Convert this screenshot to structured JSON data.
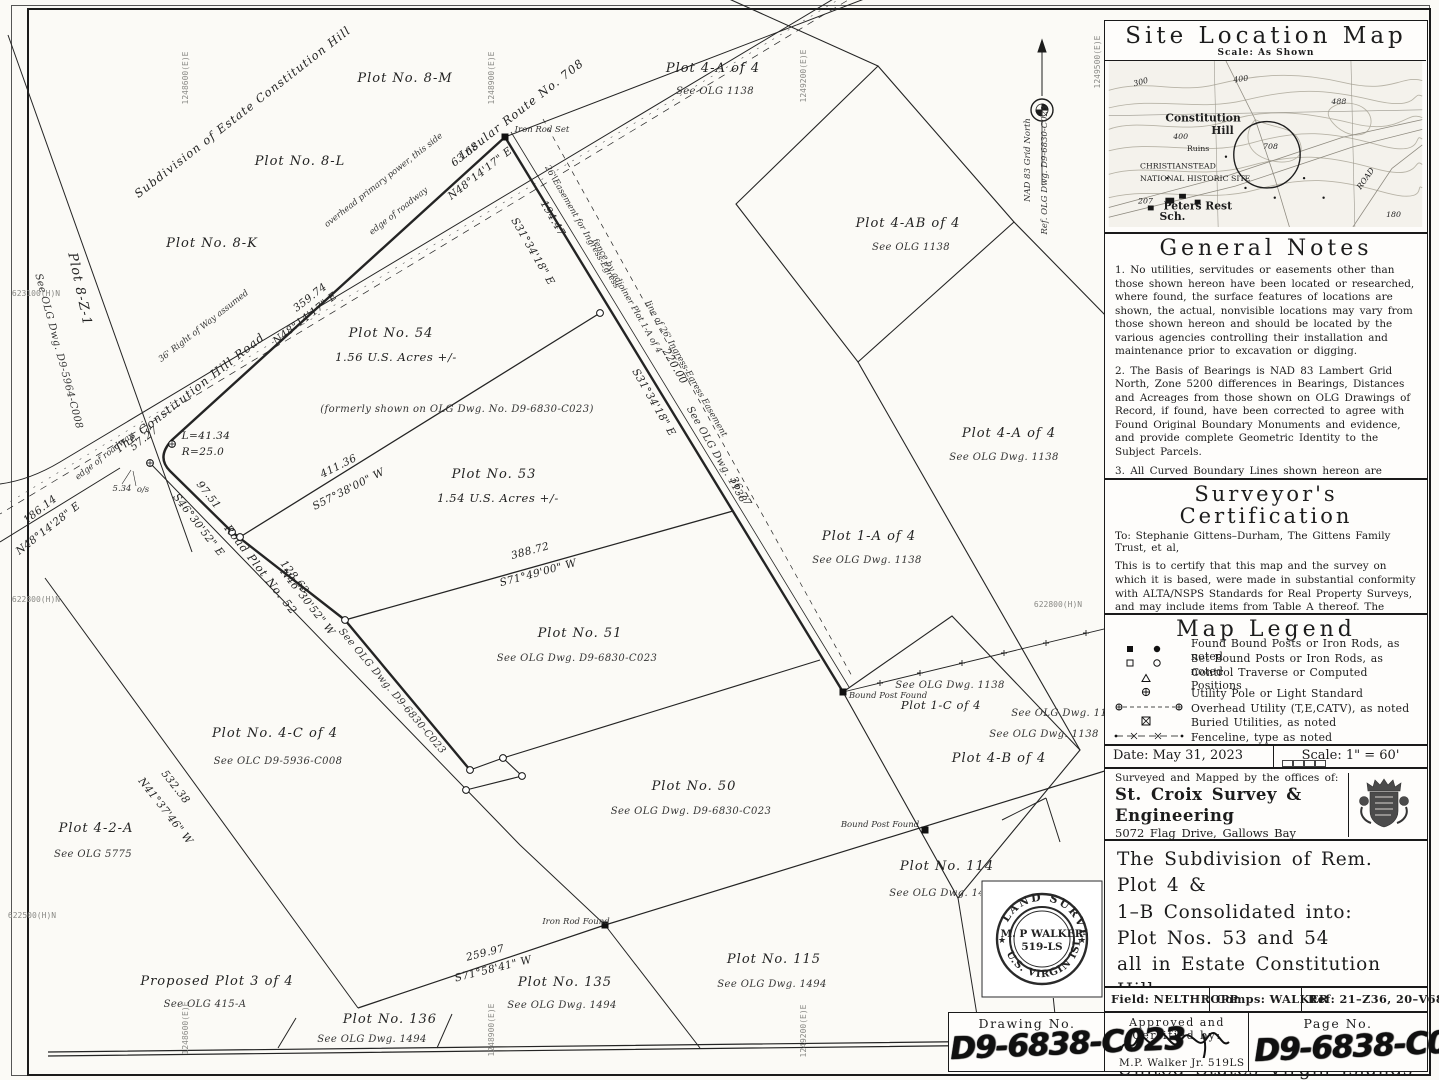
{
  "site_map": {
    "title": "Site Location Map",
    "scale_note": "Scale: As Shown",
    "topo_labels": [
      {
        "t": "300",
        "x": 26,
        "y": 26,
        "r": -15,
        "c": "sm"
      },
      {
        "t": "400",
        "x": 128,
        "y": 22,
        "r": -8,
        "c": "sm"
      },
      {
        "t": "488",
        "x": 228,
        "y": 44,
        "r": 0,
        "c": "sm"
      },
      {
        "t": "Constitution",
        "x": 58,
        "y": 62,
        "r": 0,
        "c": "big"
      },
      {
        "t": "Hill",
        "x": 105,
        "y": 75,
        "r": 0,
        "c": "big"
      },
      {
        "t": "400",
        "x": 66,
        "y": 80,
        "r": 0,
        "c": "sm"
      },
      {
        "t": "Ruins",
        "x": 80,
        "y": 92,
        "r": 0,
        "c": "med"
      },
      {
        "t": "708",
        "x": 158,
        "y": 90,
        "r": 0,
        "c": "sm"
      },
      {
        "t": "CHRISTIANSTEAD",
        "x": 32,
        "y": 110,
        "r": 0,
        "c": "med"
      },
      {
        "t": "NATIONAL HISTORIC SITE",
        "x": 32,
        "y": 123,
        "r": 0,
        "c": "med"
      },
      {
        "t": "207",
        "x": 30,
        "y": 146,
        "r": 0,
        "c": "sm"
      },
      {
        "t": "Peters Rest",
        "x": 56,
        "y": 152,
        "r": 0,
        "c": "big"
      },
      {
        "t": "Sch.",
        "x": 52,
        "y": 163,
        "r": 0,
        "c": "big"
      },
      {
        "t": "ROAD",
        "x": 258,
        "y": 132,
        "r": -55,
        "c": "sm"
      },
      {
        "t": "180",
        "x": 284,
        "y": 160,
        "r": 0,
        "c": "sm"
      }
    ]
  },
  "general_notes": {
    "title": "General Notes",
    "notes": [
      "1. No utilities, servitudes or easements other than those shown hereon have been located or researched, where found, the surface features of locations are shown, the actual, nonvisible locations may vary from those shown hereon and should be located by the various agencies controlling their installation and maintenance prior to excavation or digging.",
      "2. The Basis of Bearings is NAD 83 Lambert Grid North, Zone 5200 differences in Bearings, Distances and Acreages from those shown on OLG Drawings of Record, if found, have been corrected to agree with Found Original Boundary Monuments and evidence, and provide complete Geometric Identity to the Subject Parcels.",
      "3. All Curved Boundary Lines shown hereon are tangential to their connecting lines unless specifically shown otherwise.",
      "4. Pt. \"A\" shown hereon was held good for initial Record Position Line \"A\"–\"B\" was held good for Record Direction and all Found Monuments and Improvements were rotated and translated thereto.",
      "5. Subject Parcels appear to be in F.E.M.A. Flood Zone X.",
      "6. Subject Parcels appear to be in Planning Board Zone R–1.",
      "7. Reference OLG Dwg. (D9–6830–C023), and others, as noted."
    ]
  },
  "certification": {
    "title": "Surveyor's Certification",
    "to": "To: Stephanie Gittens–Durham, The Gittens Family Trust, et al,",
    "body": "This is to certify that this map and the survey on which it is based, were made in substantial conformity with ALTA/NSPS Standards for Real Property Surveys, and may include items from Table A thereof. The measurement of lines, angles and distances shown hereon, and the coordinates calculated from same, if shown, are in substantial conformity with positional tolerances established and accepted as best practices in the United States Virgin Islands, as of this date.",
    "date": "Date: May 31, 2023",
    "signed": "Signed: M.P. Walker Jr. PLS 519 LS"
  },
  "map_legend": {
    "title": "Map Legend",
    "rows": [
      {
        "sym": "found",
        "label": "Found Bound Posts or Iron Rods, as noted"
      },
      {
        "sym": "set",
        "label": "Set Bound Posts or Iron Rods, as noted"
      },
      {
        "sym": "traverse",
        "label": "Control Traverse or Computed Positions"
      },
      {
        "sym": "pole",
        "label": "Utility Pole or Light Standard"
      },
      {
        "sym": "overhead",
        "label": "Overhead Utility (T,E,CATV), as noted"
      },
      {
        "sym": "buried",
        "label": "Buried Utilities, as noted"
      },
      {
        "sym": "fence",
        "label": "Fenceline, type as noted"
      },
      {
        "sym": "boundary",
        "label": "Subject Plot Boundary Line"
      }
    ]
  },
  "daterow": {
    "date": "Date: May 31, 2023",
    "scale": "Scale: 1\" = 60'"
  },
  "firm": {
    "intro": "Surveyed and Mapped by the offices of:",
    "name": "St. Croix Survey & Engineering",
    "addr1": "5072 Flag Drive, Gallows Bay",
    "addr2": "Christiansted, V.I. 00820",
    "tel": "Tlf.:340.773.5577",
    "web": "www.stxsurvey.com"
  },
  "title_block": {
    "lines": [
      "The Subdivision of Rem. Plot 4 &",
      "1–B Consolidated into:",
      "Plot Nos. 53 and 54",
      "all in Estate Constitution Hill",
      "in the Company Quarter",
      "Island of St. Croix",
      "United States Virgin Islands"
    ]
  },
  "refs": {
    "field": "Field: NELTHROPP",
    "comps": "Comps: WALKER",
    "ref": "Ref: 21–Z36, 20–V68"
  },
  "bottom": {
    "drawing_label": "Drawing No.",
    "drawing_no": "D9-6838-C023",
    "approved_label": "Approved and Certified by:",
    "approver": "M.P. Walker Jr. 519LS",
    "page_label": "Page No.",
    "page_no": "D9-6838-C023"
  },
  "seal": {
    "top": "LAND SURVEYOR",
    "name": "M. P WALKER",
    "number": "519-LS",
    "bottom": "U.S. VIRGIN ISLANDS"
  },
  "map": {
    "labels": [
      {
        "t": "Subdivision of Estate Constitution Hill",
        "x": 245,
        "y": 115,
        "r": -38,
        "c": "road"
      },
      {
        "t": "Plot No. 8-M",
        "x": 405,
        "y": 82,
        "r": 0,
        "c": "plot"
      },
      {
        "t": "Plot No. 8-L",
        "x": 300,
        "y": 165,
        "r": 0,
        "c": "plot"
      },
      {
        "t": "Plot No. 8-K",
        "x": 212,
        "y": 247,
        "r": 0,
        "c": "plot"
      },
      {
        "t": "Plot 8-Z-1",
        "x": 76,
        "y": 290,
        "r": 78,
        "c": "plot"
      },
      {
        "t": "See OLG Dwg. D9-5964-C008",
        "x": 56,
        "y": 352,
        "r": 75,
        "c": "ref"
      },
      {
        "t": "Insular Route No. 708",
        "x": 524,
        "y": 112,
        "r": -38,
        "c": "road"
      },
      {
        "t": "Iron Rod Set",
        "x": 542,
        "y": 132,
        "r": 0,
        "c": "tiny"
      },
      {
        "t": "63.68",
        "x": 467,
        "y": 157,
        "r": -38,
        "c": "dim"
      },
      {
        "t": "N48°14'17\" E",
        "x": 482,
        "y": 176,
        "r": -38,
        "c": "dim"
      },
      {
        "t": "overhead primary power, this side",
        "x": 385,
        "y": 182,
        "r": -38,
        "c": "tiny"
      },
      {
        "t": "edge of roadway",
        "x": 400,
        "y": 213,
        "r": -38,
        "c": "tiny"
      },
      {
        "t": "36' Right of Way assumed",
        "x": 205,
        "y": 328,
        "r": -38,
        "c": "tiny"
      },
      {
        "t": "edge of roadway",
        "x": 106,
        "y": 458,
        "r": -38,
        "c": "tiny"
      },
      {
        "t": "The Constitution Hill Road",
        "x": 192,
        "y": 396,
        "r": -38,
        "c": "road"
      },
      {
        "t": "359.74",
        "x": 312,
        "y": 300,
        "r": -38,
        "c": "dim"
      },
      {
        "t": "N48°14'17\" E",
        "x": 307,
        "y": 321,
        "r": -38,
        "c": "dim"
      },
      {
        "t": "194.47",
        "x": 550,
        "y": 220,
        "r": 60,
        "c": "dim"
      },
      {
        "t": "S31°34'18\" E",
        "x": 530,
        "y": 253,
        "r": 60,
        "c": "dim"
      },
      {
        "t": "26' Easement for Ingress-Egress",
        "x": 580,
        "y": 228,
        "r": 60,
        "c": "tiny"
      },
      {
        "t": "fence by adjoiner Plot 1-A of 4",
        "x": 625,
        "y": 297,
        "r": 60,
        "c": "tiny"
      },
      {
        "t": "line of 26' Ingress-Egress Easement",
        "x": 684,
        "y": 370,
        "r": 60,
        "c": "tiny"
      },
      {
        "t": "220.00",
        "x": 672,
        "y": 368,
        "r": 60,
        "c": "dim"
      },
      {
        "t": "S31°34'18\" E",
        "x": 651,
        "y": 404,
        "r": 60,
        "c": "dim"
      },
      {
        "t": "See OLG Dwg. 1138",
        "x": 714,
        "y": 456,
        "r": 60,
        "c": "ref"
      },
      {
        "t": "36.77",
        "x": 738,
        "y": 493,
        "r": 60,
        "c": "dim"
      },
      {
        "t": "Plot No. 54",
        "x": 391,
        "y": 337,
        "r": 0,
        "c": "plot"
      },
      {
        "t": "1.56 U.S. Acres +/-",
        "x": 396,
        "y": 361,
        "r": 0,
        "c": "plot2"
      },
      {
        "t": "(formerly shown on OLG Dwg. No. D9-6830-C023)",
        "x": 457,
        "y": 412,
        "r": 0,
        "c": "ref"
      },
      {
        "t": "L=41.34",
        "x": 206,
        "y": 439,
        "r": 0,
        "c": "dim"
      },
      {
        "t": "R=25.0",
        "x": 203,
        "y": 455,
        "r": 0,
        "c": "dim"
      },
      {
        "t": "57.27",
        "x": 146,
        "y": 441,
        "r": -38,
        "c": "dim"
      },
      {
        "t": "5.34",
        "x": 122,
        "y": 491,
        "r": 0,
        "c": "tiny"
      },
      {
        "t": "o/s",
        "x": 143,
        "y": 492,
        "r": 0,
        "c": "tiny"
      },
      {
        "t": "186.14",
        "x": 42,
        "y": 512,
        "r": -38,
        "c": "dim"
      },
      {
        "t": "N48°14'28\" E",
        "x": 50,
        "y": 531,
        "r": -38,
        "c": "dim"
      },
      {
        "t": "411.36",
        "x": 340,
        "y": 469,
        "r": -27,
        "c": "dim"
      },
      {
        "t": "S57°38'00\" W",
        "x": 350,
        "y": 492,
        "r": -27,
        "c": "dim"
      },
      {
        "t": "Plot No. 53",
        "x": 494,
        "y": 478,
        "r": 0,
        "c": "plot"
      },
      {
        "t": "1.54 U.S. Acres +/-",
        "x": 498,
        "y": 502,
        "r": 0,
        "c": "plot2"
      },
      {
        "t": "97.51",
        "x": 206,
        "y": 497,
        "r": 52,
        "c": "dim"
      },
      {
        "t": "S46°30'52\" E",
        "x": 196,
        "y": 527,
        "r": 52,
        "c": "dim"
      },
      {
        "t": "Road Plot No. 52",
        "x": 258,
        "y": 572,
        "r": 52,
        "c": "road2"
      },
      {
        "t": "128.63",
        "x": 292,
        "y": 579,
        "r": 52,
        "c": "dim"
      },
      {
        "t": "N46°30'52\" W",
        "x": 305,
        "y": 604,
        "r": 52,
        "c": "dim"
      },
      {
        "t": "388.72",
        "x": 531,
        "y": 554,
        "r": -15,
        "c": "dim"
      },
      {
        "t": "S71°49'00\" W",
        "x": 539,
        "y": 576,
        "r": -15,
        "c": "dim"
      },
      {
        "t": "Plot No. 51",
        "x": 580,
        "y": 637,
        "r": 0,
        "c": "plot"
      },
      {
        "t": "See OLG Dwg. D9-6830-C023",
        "x": 577,
        "y": 661,
        "r": 0,
        "c": "ref"
      },
      {
        "t": "See OLG Dwg. D9-6830-C023",
        "x": 390,
        "y": 693,
        "r": 50,
        "c": "ref"
      },
      {
        "t": "Plot No. 4-C of 4",
        "x": 275,
        "y": 737,
        "r": 0,
        "c": "plot"
      },
      {
        "t": "See OLC D9-5936-C008",
        "x": 278,
        "y": 764,
        "r": 0,
        "c": "ref"
      },
      {
        "t": "532.38",
        "x": 173,
        "y": 789,
        "r": 52,
        "c": "dim"
      },
      {
        "t": "N41°37'46\" W",
        "x": 163,
        "y": 813,
        "r": 52,
        "c": "dim"
      },
      {
        "t": "Plot 4-2-A",
        "x": 96,
        "y": 832,
        "r": 0,
        "c": "plot"
      },
      {
        "t": "See OLG 5775",
        "x": 93,
        "y": 857,
        "r": 0,
        "c": "ref"
      },
      {
        "t": "Plot No. 50",
        "x": 694,
        "y": 790,
        "r": 0,
        "c": "plot"
      },
      {
        "t": "See OLG Dwg. D9-6830-C023",
        "x": 691,
        "y": 814,
        "r": 0,
        "c": "ref"
      },
      {
        "t": "Plot 1-A of 4",
        "x": 869,
        "y": 540,
        "r": 0,
        "c": "plot"
      },
      {
        "t": "See OLG Dwg. 1138",
        "x": 867,
        "y": 563,
        "r": 0,
        "c": "ref"
      },
      {
        "t": "Plot 4-A of 4",
        "x": 1009,
        "y": 437,
        "r": 0,
        "c": "plot"
      },
      {
        "t": "See OLG Dwg. 1138",
        "x": 1004,
        "y": 460,
        "r": 0,
        "c": "ref"
      },
      {
        "t": "Plot 4-A of 4",
        "x": 713,
        "y": 72,
        "r": 0,
        "c": "plot"
      },
      {
        "t": "See OLG 1138",
        "x": 715,
        "y": 94,
        "r": 0,
        "c": "ref"
      },
      {
        "t": "Plot 4-AB of 4",
        "x": 908,
        "y": 227,
        "r": 0,
        "c": "plot"
      },
      {
        "t": "See OLG 1138",
        "x": 911,
        "y": 250,
        "r": 0,
        "c": "ref"
      },
      {
        "t": "Bound Post Found",
        "x": 888,
        "y": 698,
        "r": 0,
        "c": "tiny"
      },
      {
        "t": "See OLG Dwg. 1138",
        "x": 950,
        "y": 688,
        "r": 0,
        "c": "ref"
      },
      {
        "t": "Plot 1-C of 4",
        "x": 941,
        "y": 709,
        "r": 0,
        "c": "plot2"
      },
      {
        "t": "See OLG Dwg. 1138",
        "x": 1066,
        "y": 716,
        "r": 0,
        "c": "ref"
      },
      {
        "t": "See OLG Dwg. 1138",
        "x": 1044,
        "y": 737,
        "r": 0,
        "c": "ref"
      },
      {
        "t": "Plot 4-B of 4",
        "x": 999,
        "y": 762,
        "r": 0,
        "c": "plot"
      },
      {
        "t": "Plot No. 114",
        "x": 947,
        "y": 870,
        "r": 0,
        "c": "plot"
      },
      {
        "t": "See OLG Dwg. 1494",
        "x": 944,
        "y": 896,
        "r": 0,
        "c": "ref"
      },
      {
        "t": "Bound Post Found",
        "x": 880,
        "y": 827,
        "r": 0,
        "c": "tiny"
      },
      {
        "t": "Iron Rod Found",
        "x": 576,
        "y": 924,
        "r": 0,
        "c": "tiny"
      },
      {
        "t": "259.97",
        "x": 486,
        "y": 956,
        "r": -14,
        "c": "dim"
      },
      {
        "t": "S71°58'41\" W",
        "x": 494,
        "y": 972,
        "r": -14,
        "c": "dim"
      },
      {
        "t": "Plot No. 135",
        "x": 565,
        "y": 986,
        "r": 0,
        "c": "plot"
      },
      {
        "t": "See OLG Dwg. 1494",
        "x": 562,
        "y": 1008,
        "r": 0,
        "c": "ref"
      },
      {
        "t": "Plot No. 115",
        "x": 774,
        "y": 963,
        "r": 0,
        "c": "plot"
      },
      {
        "t": "See OLG Dwg. 1494",
        "x": 772,
        "y": 987,
        "r": 0,
        "c": "ref"
      },
      {
        "t": "Plot No. 136",
        "x": 390,
        "y": 1023,
        "r": 0,
        "c": "plot"
      },
      {
        "t": "See OLG Dwg. 1494",
        "x": 372,
        "y": 1042,
        "r": 0,
        "c": "ref"
      },
      {
        "t": "Proposed Plot 3 of 4",
        "x": 217,
        "y": 985,
        "r": 0,
        "c": "plot"
      },
      {
        "t": "See OLG 415-A",
        "x": 205,
        "y": 1007,
        "r": 0,
        "c": "ref"
      },
      {
        "t": "NAD 83 Grid North",
        "x": 1030,
        "y": 160,
        "r": -90,
        "c": "tiny"
      },
      {
        "t": "Ref. OLG Dwg. D9-6830-C023",
        "x": 1047,
        "y": 170,
        "r": -90,
        "c": "tiny"
      }
    ],
    "grid_labels": [
      {
        "t": "1248600(E)E",
        "x": 188,
        "y": 78,
        "r": -90
      },
      {
        "t": "1248900(E)E",
        "x": 494,
        "y": 78,
        "r": -90
      },
      {
        "t": "1249200(E)E",
        "x": 806,
        "y": 76,
        "r": -90
      },
      {
        "t": "1249500(E)E",
        "x": 1100,
        "y": 62,
        "r": -90
      },
      {
        "t": "1248600(E)E",
        "x": 188,
        "y": 1028,
        "r": -90
      },
      {
        "t": "1248900(E)E",
        "x": 494,
        "y": 1030,
        "r": -90
      },
      {
        "t": "1249200(E)E",
        "x": 806,
        "y": 1031,
        "r": -90
      },
      {
        "t": "623100(H)N",
        "x": 36,
        "y": 296,
        "r": 0
      },
      {
        "t": "622800(H)N",
        "x": 36,
        "y": 602,
        "r": 0
      },
      {
        "t": "622500(H)N",
        "x": 32,
        "y": 918,
        "r": 0
      },
      {
        "t": "622800(H)N",
        "x": 1058,
        "y": 607,
        "r": 0
      }
    ],
    "markers": [
      {
        "type": "sq",
        "x": 505,
        "y": 137
      },
      {
        "type": "sq",
        "x": 843,
        "y": 692
      },
      {
        "type": "sq",
        "x": 925,
        "y": 830
      },
      {
        "type": "sq",
        "x": 605,
        "y": 925
      },
      {
        "type": "xcirc",
        "x": 172,
        "y": 444
      },
      {
        "type": "xcirc",
        "x": 150,
        "y": 463
      },
      {
        "type": "circ",
        "x": 232,
        "y": 532
      },
      {
        "type": "circ",
        "x": 345,
        "y": 620
      },
      {
        "type": "circ",
        "x": 240,
        "y": 537
      },
      {
        "type": "circ",
        "x": 600,
        "y": 313
      },
      {
        "type": "circ",
        "x": 470,
        "y": 770
      },
      {
        "type": "circ",
        "x": 503,
        "y": 758
      },
      {
        "type": "circ",
        "x": 522,
        "y": 776
      },
      {
        "type": "circ",
        "x": 466,
        "y": 790
      },
      {
        "type": "tick",
        "x": 880,
        "y": 683
      },
      {
        "type": "tick",
        "x": 920,
        "y": 673
      },
      {
        "type": "tick",
        "x": 962,
        "y": 663
      },
      {
        "type": "tick",
        "x": 1004,
        "y": 653
      },
      {
        "type": "tick",
        "x": 1046,
        "y": 643
      },
      {
        "type": "tick",
        "x": 1086,
        "y": 633
      }
    ]
  }
}
